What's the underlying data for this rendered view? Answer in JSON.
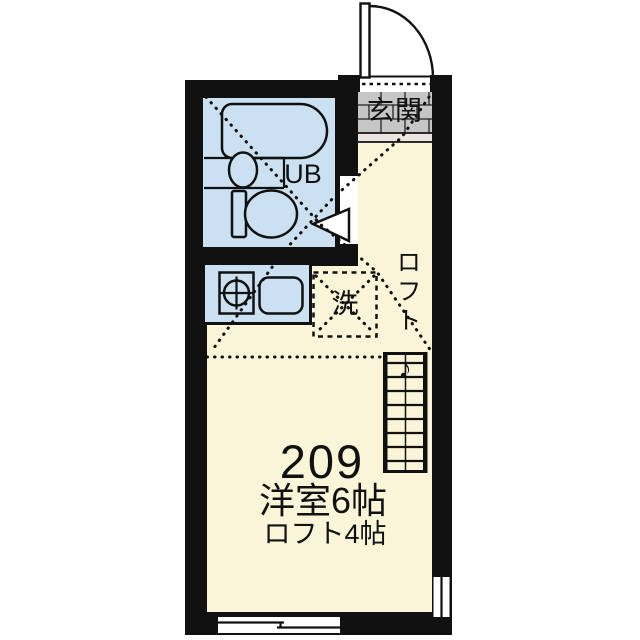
{
  "floorplan": {
    "unit": {
      "room_number": "209",
      "room_type_size": "洋室6帖",
      "loft_size": "ロフト4帖"
    },
    "labels": {
      "entrance": "玄関",
      "unit_bath": "UB",
      "washing_machine": "洗",
      "loft": "ロフト",
      "ladder_up_arrow": "♪"
    },
    "fixtures": [
      "bathtub",
      "washbasin",
      "toilet",
      "kitchen-stove",
      "kitchen-sink",
      "washing-machine-space",
      "entrance-door",
      "bathroom-door",
      "loft-ladder",
      "window-bottom",
      "window-right"
    ],
    "colors": {
      "wall": "#111111",
      "floor": "#FAF5D9",
      "wet_area": "#CBE1F1",
      "entrance_tile": "#C6C6C6",
      "entrance_step": "#EDE3E0",
      "background": "#FFFFFF"
    }
  }
}
